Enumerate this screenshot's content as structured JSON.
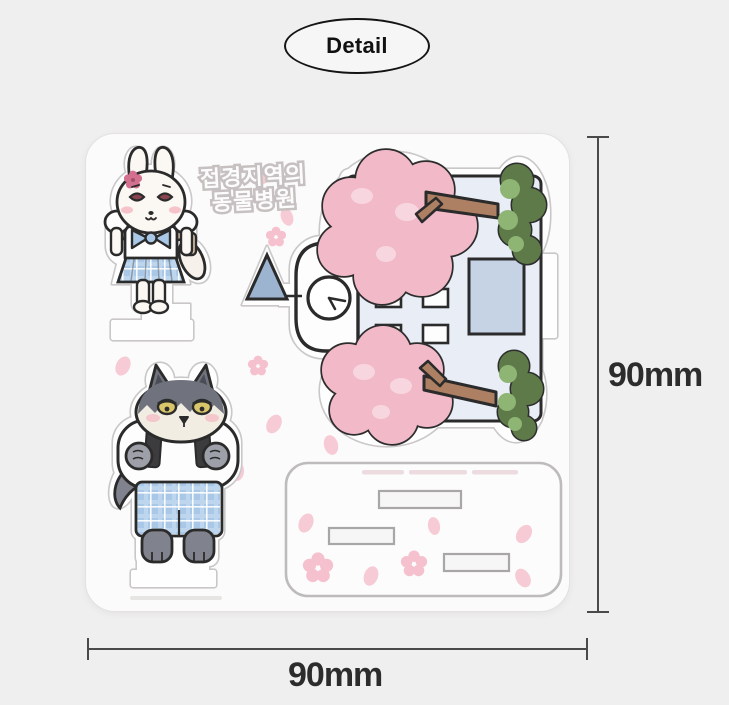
{
  "badge": {
    "label": "Detail"
  },
  "kit": {
    "title_line1": "접경지역의",
    "title_line2": "동물병원",
    "pieces": [
      {
        "name": "bunny-student-standee"
      },
      {
        "name": "wolf-student-standee"
      },
      {
        "name": "animal-hospital-building-standee"
      },
      {
        "name": "base-stand-with-three-slots"
      }
    ]
  },
  "dimensions": {
    "width_label": "90mm",
    "height_label": "90mm"
  },
  "colors": {
    "background": "#f0efef",
    "acrylic_plate": "#fcfbfb",
    "die_cut_line": "#c9c7c7",
    "outline": "#2b2b2b",
    "uniform_blue": "#a9c8e8",
    "blossom_pink": "#f2bac9",
    "petal_pink": "#f7cbd5",
    "leaf_green_dark": "#5d7a48",
    "leaf_green_light": "#8eb573",
    "trunk_brown": "#ad7f63",
    "building_body": "#e8edf6",
    "door_blue": "#c5d3e4",
    "wolf_grey": "#70737d",
    "strap_black": "#3c3c3e",
    "strap_tan": "#d9c4a9",
    "eye_red": "#8a4350",
    "eye_yellow": "#d9c66b"
  }
}
